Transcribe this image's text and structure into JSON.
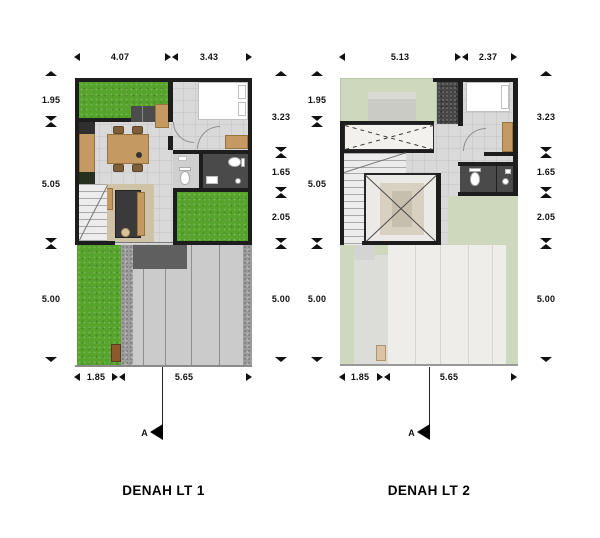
{
  "plan1": {
    "title": "DENAH LT 1",
    "dims_top": [
      "4.07",
      "3.43"
    ],
    "dims_bottom": [
      "1.85",
      "5.65"
    ],
    "dims_left": [
      "1.95",
      "5.05",
      "5.00"
    ],
    "dims_right": [
      "3.23",
      "1.65",
      "2.05",
      "5.00"
    ],
    "section_label": "A"
  },
  "plan2": {
    "title": "DENAH LT 2",
    "dims_top": [
      "5.13",
      "2.37"
    ],
    "dims_bottom": [
      "1.85",
      "5.65"
    ],
    "dims_left": [
      "1.95",
      "5.05",
      "5.00"
    ],
    "dims_right": [
      "3.23",
      "1.65",
      "2.05",
      "5.00"
    ],
    "section_label": "A"
  },
  "icons": {
    "dim_end_vertical": "triangle-marker",
    "dim_split_vertical": "hourglass-tick",
    "dim_end_horizontal": "arrowhead",
    "dim_split_horizontal": "bowtie-tick",
    "section_arrow": "solid-left-triangle"
  },
  "colors": {
    "wall": "#1d1d1d",
    "grass": "#57a42d",
    "roof_garden": "#cdd8bd",
    "wood": "#c49a62",
    "floor": "#d9d9d9",
    "bathroom_dark": "#4a4a4a",
    "concrete": "#cbcbcb",
    "roof_panels": "#efede9"
  }
}
